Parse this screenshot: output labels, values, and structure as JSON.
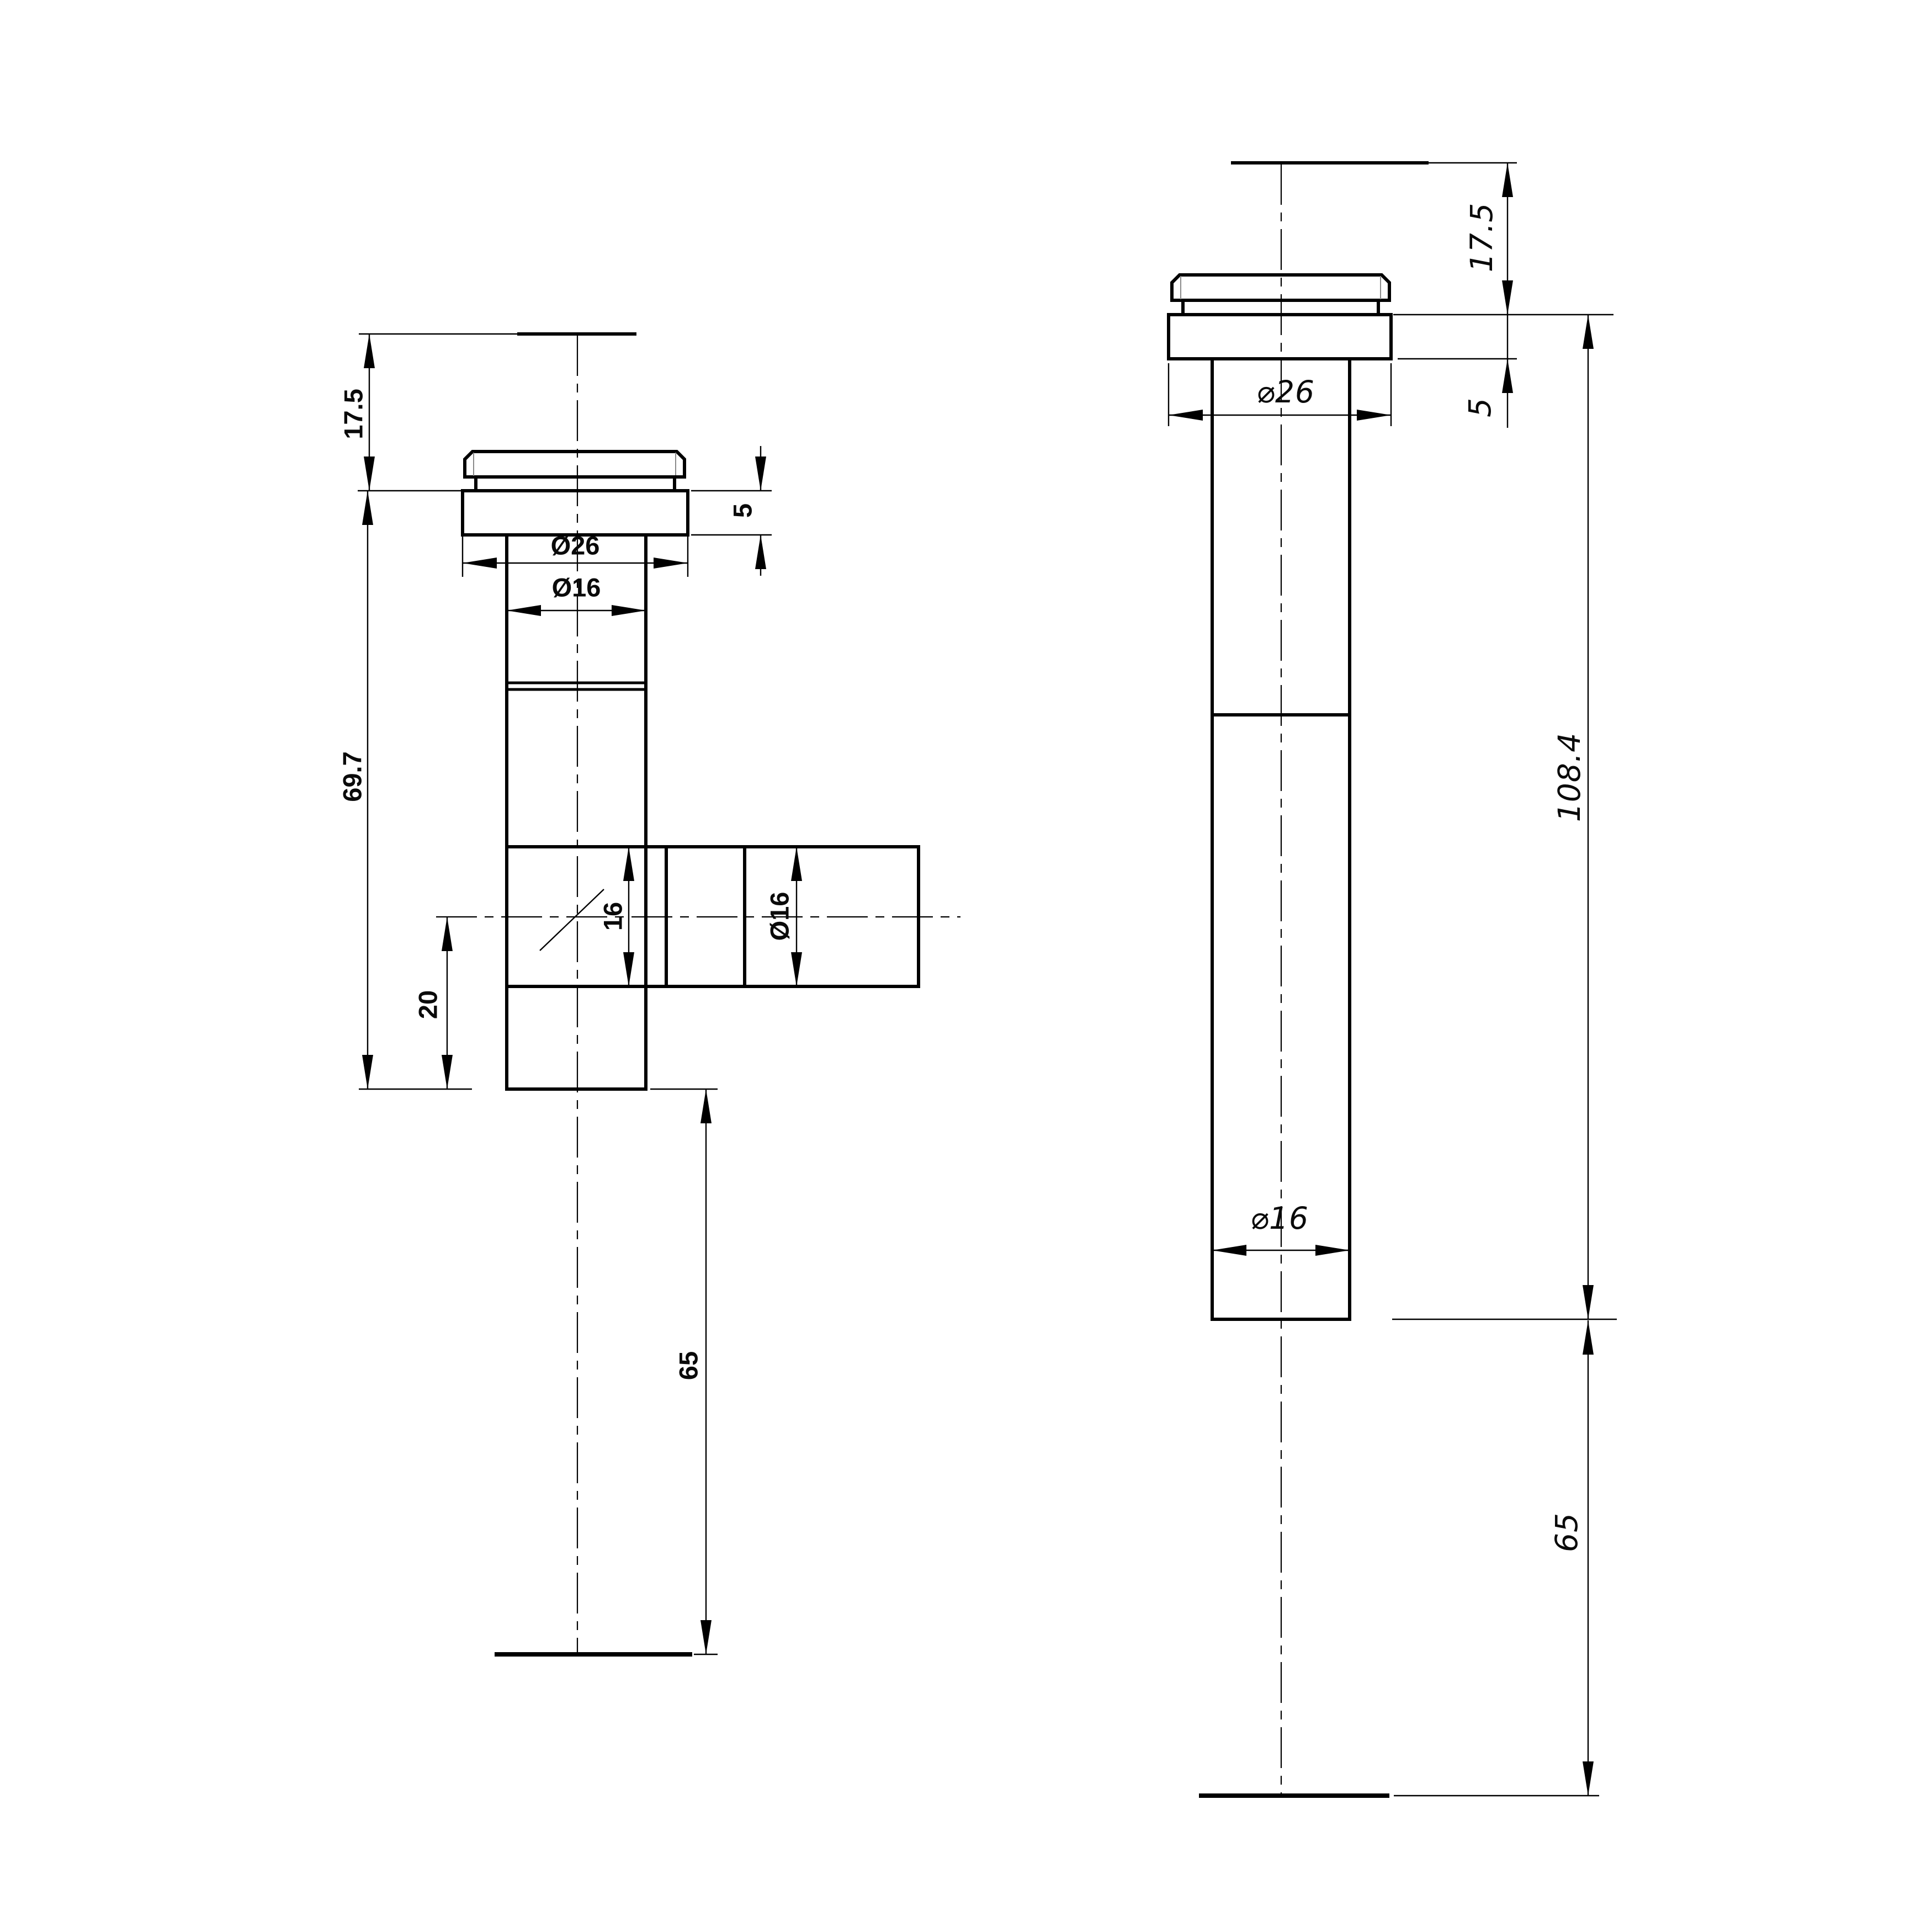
{
  "drawing": {
    "type": "technical-drawing",
    "background": "#ffffff",
    "line_color": "#000000",
    "units": "mm",
    "views": {
      "left": {
        "name": "front-view-tee-fitting",
        "dims": {
          "h17_5": "17.5",
          "h69_7": "69.7",
          "h20": "20",
          "h65": "65",
          "h5": "5",
          "d26": "Ø26",
          "d16": "Ø16",
          "bore16": "16",
          "branch_d16": "Ø16"
        },
        "values_mm": {
          "cap_height": 17.5,
          "flange_height": 5,
          "flange_diameter": 26,
          "tube_diameter": 16,
          "body_length": 69.7,
          "branch_center_from_bottom": 20,
          "branch_bore": 16,
          "branch_diameter": 16,
          "drop_below": 65
        }
      },
      "right": {
        "name": "side-view-straight-fitting",
        "dims": {
          "h17_5": "17.5",
          "h5": "5",
          "d26": "⌀26",
          "h108_4": "108.4",
          "d16": "⌀16",
          "h65": "65"
        },
        "values_mm": {
          "cap_height": 17.5,
          "flange_height": 5,
          "flange_diameter": 26,
          "tube_diameter": 16,
          "overall_length": 108.4,
          "drop_below": 65
        }
      }
    }
  }
}
